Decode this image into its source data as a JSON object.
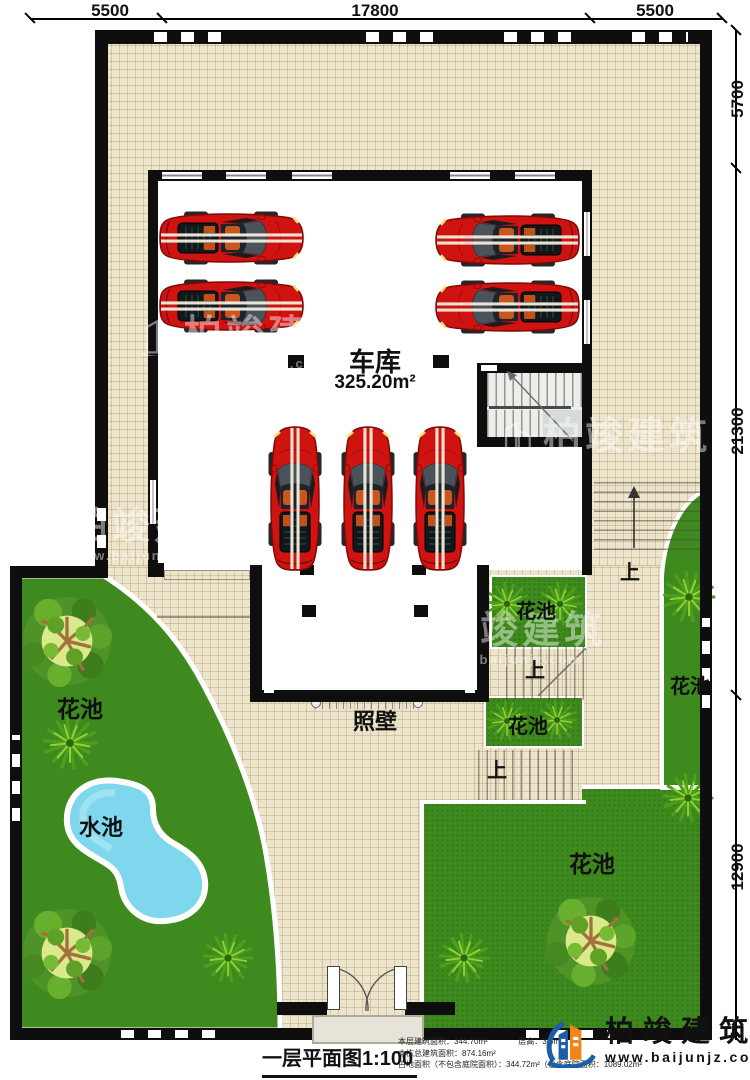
{
  "dimensions": {
    "top": [
      "5500",
      "17800",
      "5500"
    ],
    "right": [
      "5700",
      "21300",
      "12900"
    ]
  },
  "garage": {
    "name": "车库",
    "area": "325.20m²"
  },
  "labels": {
    "flower_bed": "花池",
    "water_pool": "水池",
    "screen_wall": "照壁",
    "up": "上"
  },
  "titleblock": {
    "title": "一层平面图1:100"
  },
  "stats": {
    "line1a": "本层建筑面积：344.70m²",
    "line1b": "层高：3.3m",
    "line2": "本栋总建筑面积：874.16m²",
    "line3": "占地面积（不包含庭院面积）：344.72m²（包含庭院面积：1089.02m²"
  },
  "brand": {
    "name": "柏竣建筑",
    "url": "www.baijunjz.com"
  },
  "watermark": {
    "name": "柏竣建筑",
    "url": "www.baijunjz.com"
  }
}
